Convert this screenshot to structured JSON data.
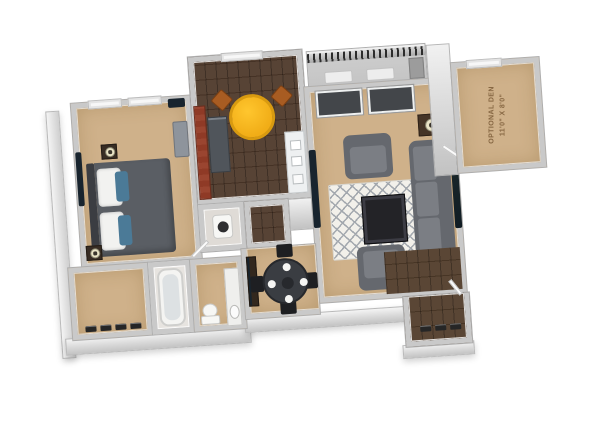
{
  "den_label": {
    "line1": "OPTIONAL DEN",
    "line2": "11'0\" X 8'0\""
  },
  "colors": {
    "background": "#ffffff",
    "wall": "#c9c9c9",
    "wall_dark": "#aeaeae",
    "carpet": "#cfb18a",
    "wood": "#4e392a",
    "wood_entry": "#513c2a",
    "glass": "#43464a",
    "sofa": "#7b7e84",
    "sofa_dark": "#65686e",
    "yellow_table": "#f1ad17",
    "rust_chair": "#a85c22",
    "brick": "#9a4530",
    "appliance": "#50555b",
    "comforter": "#5a5e64",
    "pillow_blue": "#4b7a97",
    "screen": "#18242e",
    "coffee_table": "#232327",
    "dining_table": "#3a3d42",
    "chair_black": "#1e1f22",
    "den_text": "#7a5a36",
    "rug_base": "#f2f0ea",
    "rug_line": "#a3a8ae",
    "lamp_shade": "#eae4c6",
    "balcony_floor": "#c4c4c4",
    "railing": "#2c2c2c"
  }
}
